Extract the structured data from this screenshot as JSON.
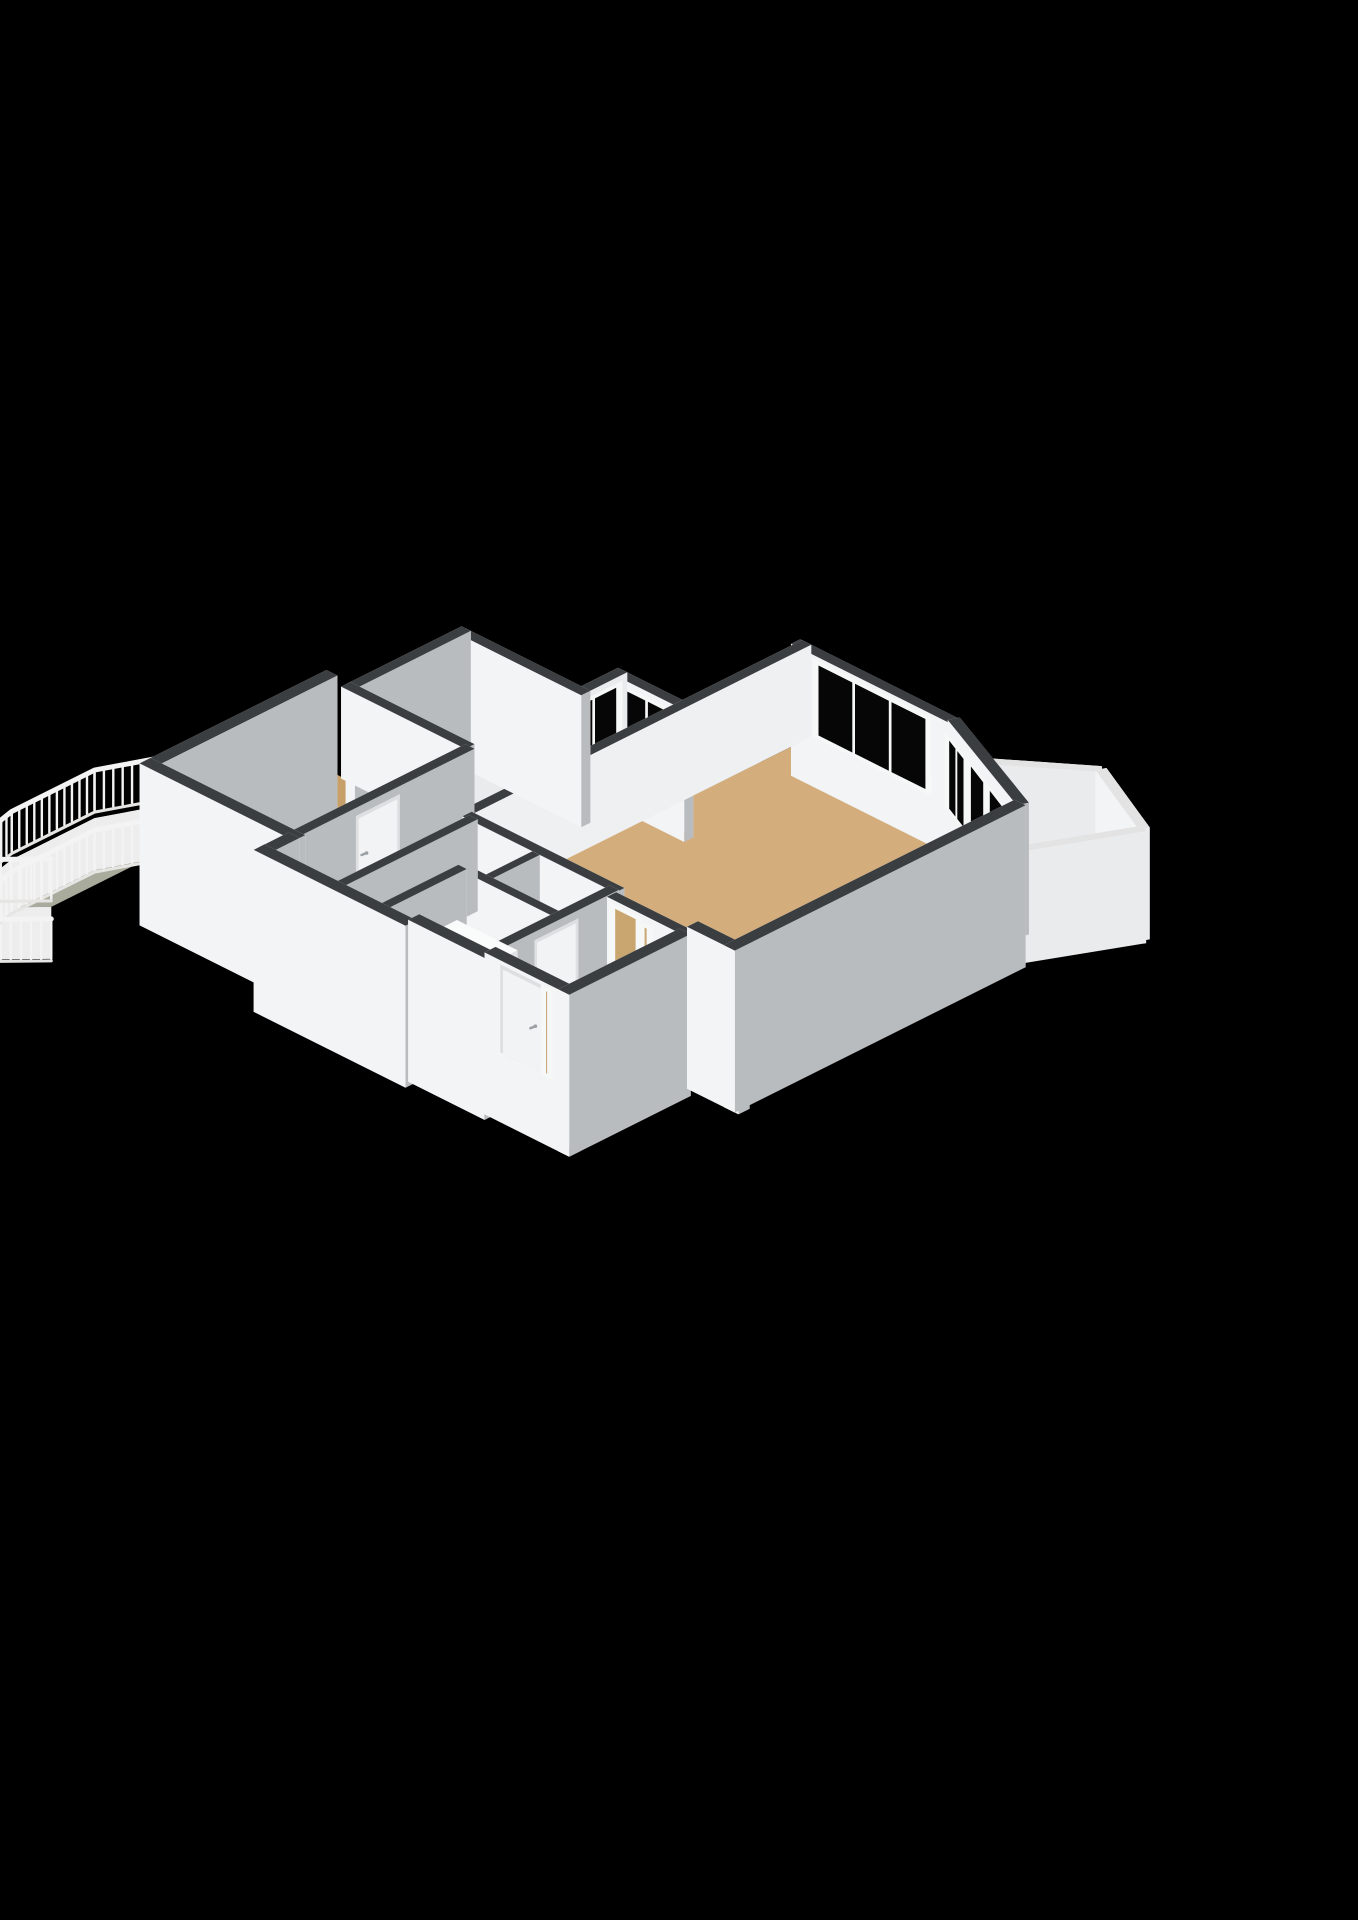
{
  "title": "3d-floorplan-render",
  "palette": {
    "background": "#000000",
    "wallCap": "#3b3e41",
    "wallLight": "#f3f4f5",
    "wallShade": "#b9bcbf",
    "wallExterior": "#e9ebed",
    "skirt": "#ededee",
    "floorWood": "#c7a069",
    "floorWoodLight": "#d3ad7c",
    "floorHall": "#cfa873",
    "floorTile": "#c9d3df",
    "floorTileLight": "#d3dce6",
    "floorBalconyLeft": "#a9ab9c",
    "floorBalconyRight": "#e7e5e0",
    "balconyTileLine": "#d9d6d0",
    "glass": "#060606",
    "glassLow": "#d9d8d3",
    "railing": "#f3f3f3",
    "parapetCap": "#e3e3e3",
    "door": "#f2f3f4",
    "frame": "#f6f7f7",
    "doorWood": "#b98d52",
    "openDoorway": "#c9a670",
    "closetFloor": "#e4e6e8",
    "cabinet": "#f7f8f8",
    "cabinetSide": "#e0e2e4",
    "niche": "#0a0a0a",
    "fixture": "#ffffff",
    "fixtureEdge": "#d0d3d5",
    "handle": "#9aa0a4"
  },
  "rooms": [
    {
      "name": "bedroom-left",
      "floor": "floorWood"
    },
    {
      "name": "bedroom-top",
      "floor": "floorWood"
    },
    {
      "name": "room-middle",
      "floor": "floorWood"
    },
    {
      "name": "living-room",
      "floor": "floorWoodLight"
    },
    {
      "name": "hallway",
      "floor": "floorHall"
    },
    {
      "name": "closet-a",
      "floor": "closetFloor"
    },
    {
      "name": "closet-b",
      "floor": "closetFloor"
    },
    {
      "name": "toilet-room",
      "floor": "floorTileLight"
    },
    {
      "name": "kitchen",
      "floor": "floorTile"
    },
    {
      "name": "vestibule",
      "floor": "floorHall"
    },
    {
      "name": "balcony-west",
      "floor": "floorBalconyLeft"
    },
    {
      "name": "terrace-east",
      "floor": "floorBalconyRight"
    }
  ],
  "fixtures": [
    "kitchen-unit",
    "toilet",
    "radiator",
    "front-door",
    "interior-door",
    "balcony-railing",
    "window",
    "glass-door"
  ]
}
